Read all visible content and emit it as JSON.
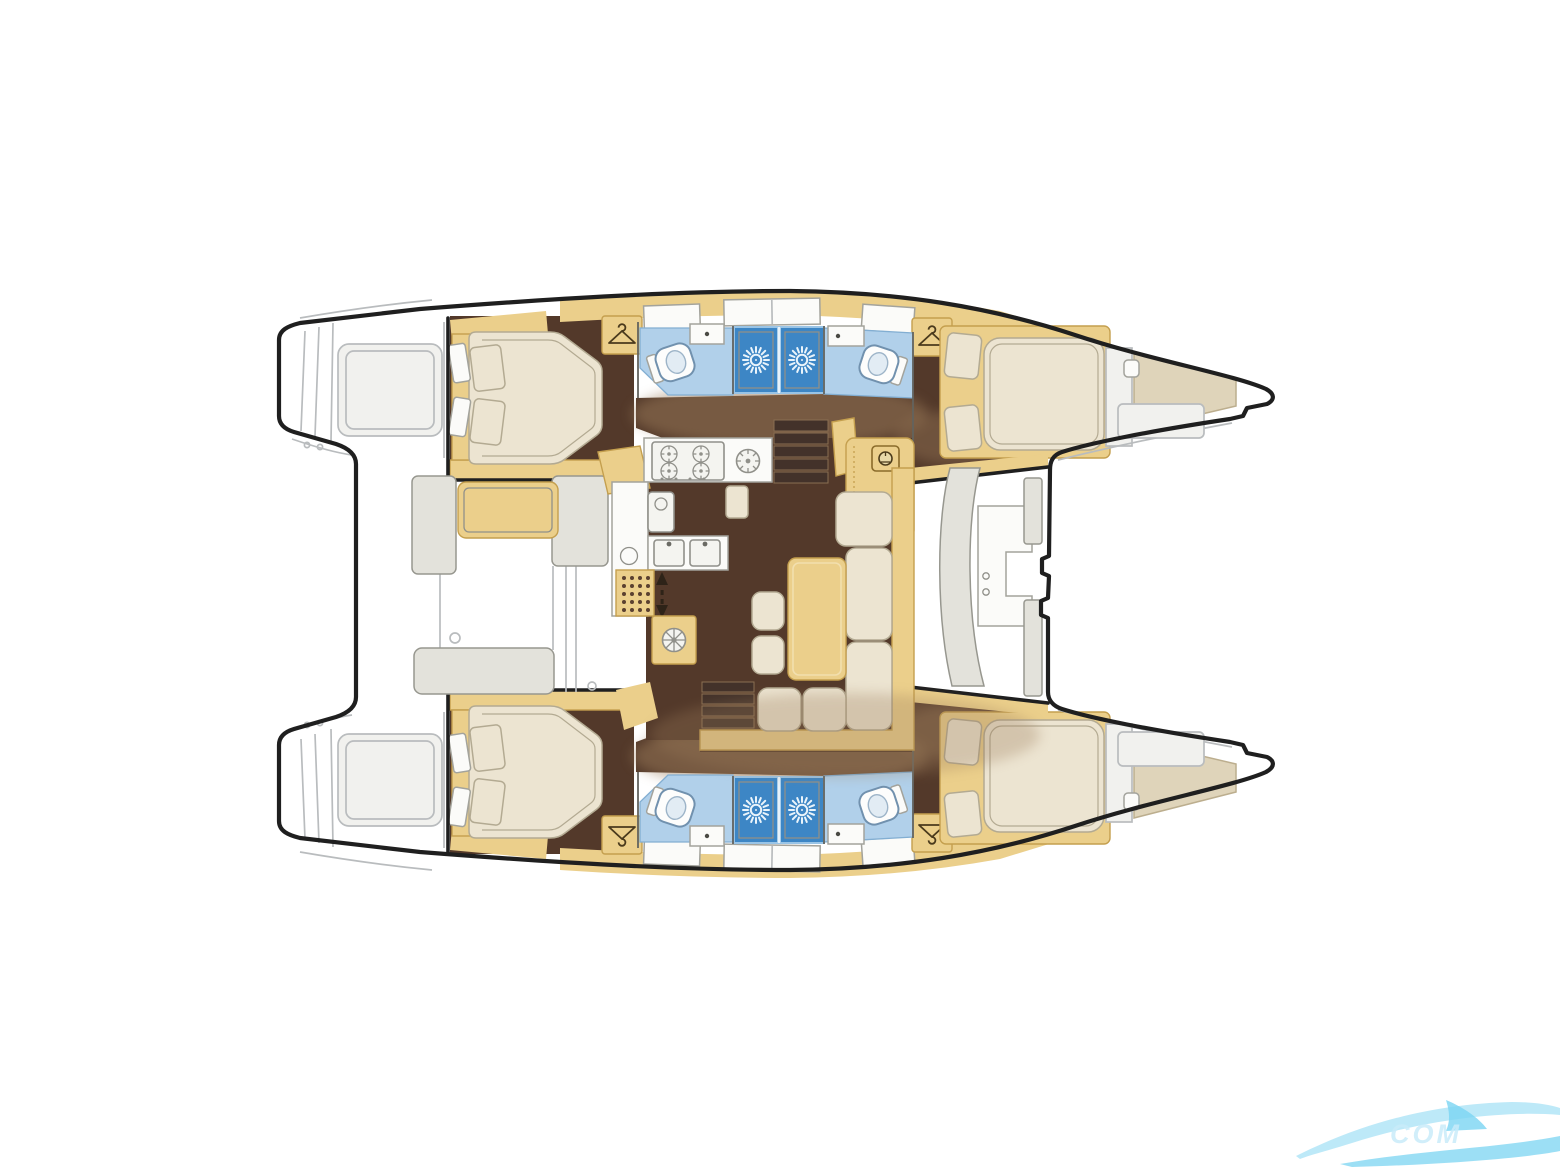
{
  "document": {
    "kind_label": "catamaran-interior-floor-plan"
  },
  "colors": {
    "paper": "#ffffff",
    "ink": "#1f1f1f",
    "wall": "#63635e",
    "ghost": "#b9bcbe",
    "ghostFill": "#f1f1ee",
    "wood": "#ebcf8b",
    "woodEdge": "#c49f4e",
    "floor": "#53392a",
    "shadow": "#9b7c5a",
    "cream": "#ece4d1",
    "creamEdge": "#b3aa92",
    "white": "#fbfbf9",
    "whiteEdge": "#a3a39c",
    "bathFloor": "#b1d0ea",
    "bathEdge": "#82aed2",
    "shower": "#3d86c5",
    "showerEdge": "#99c4e6",
    "sun": "#eaf4fb",
    "graySeat": "#e3e2db",
    "grayEdge": "#97978f",
    "watermark": "#7bd4f2",
    "watermarkText": "#c9ecfa"
  },
  "watermark": {
    "text": "COM"
  },
  "features": {
    "double_cabins": 4,
    "bow_berths": 2,
    "toilets": 4,
    "shower_stalls": 4,
    "wardrobes": 4,
    "stove_burners": 4,
    "galley_sinks": 2
  },
  "icons": {
    "shower_stall": "sun-rays-shower-icon",
    "wardrobe": "clothes-hanger-icon",
    "vent": "fan-icon",
    "companionway": "up-down-arrows-icon"
  }
}
